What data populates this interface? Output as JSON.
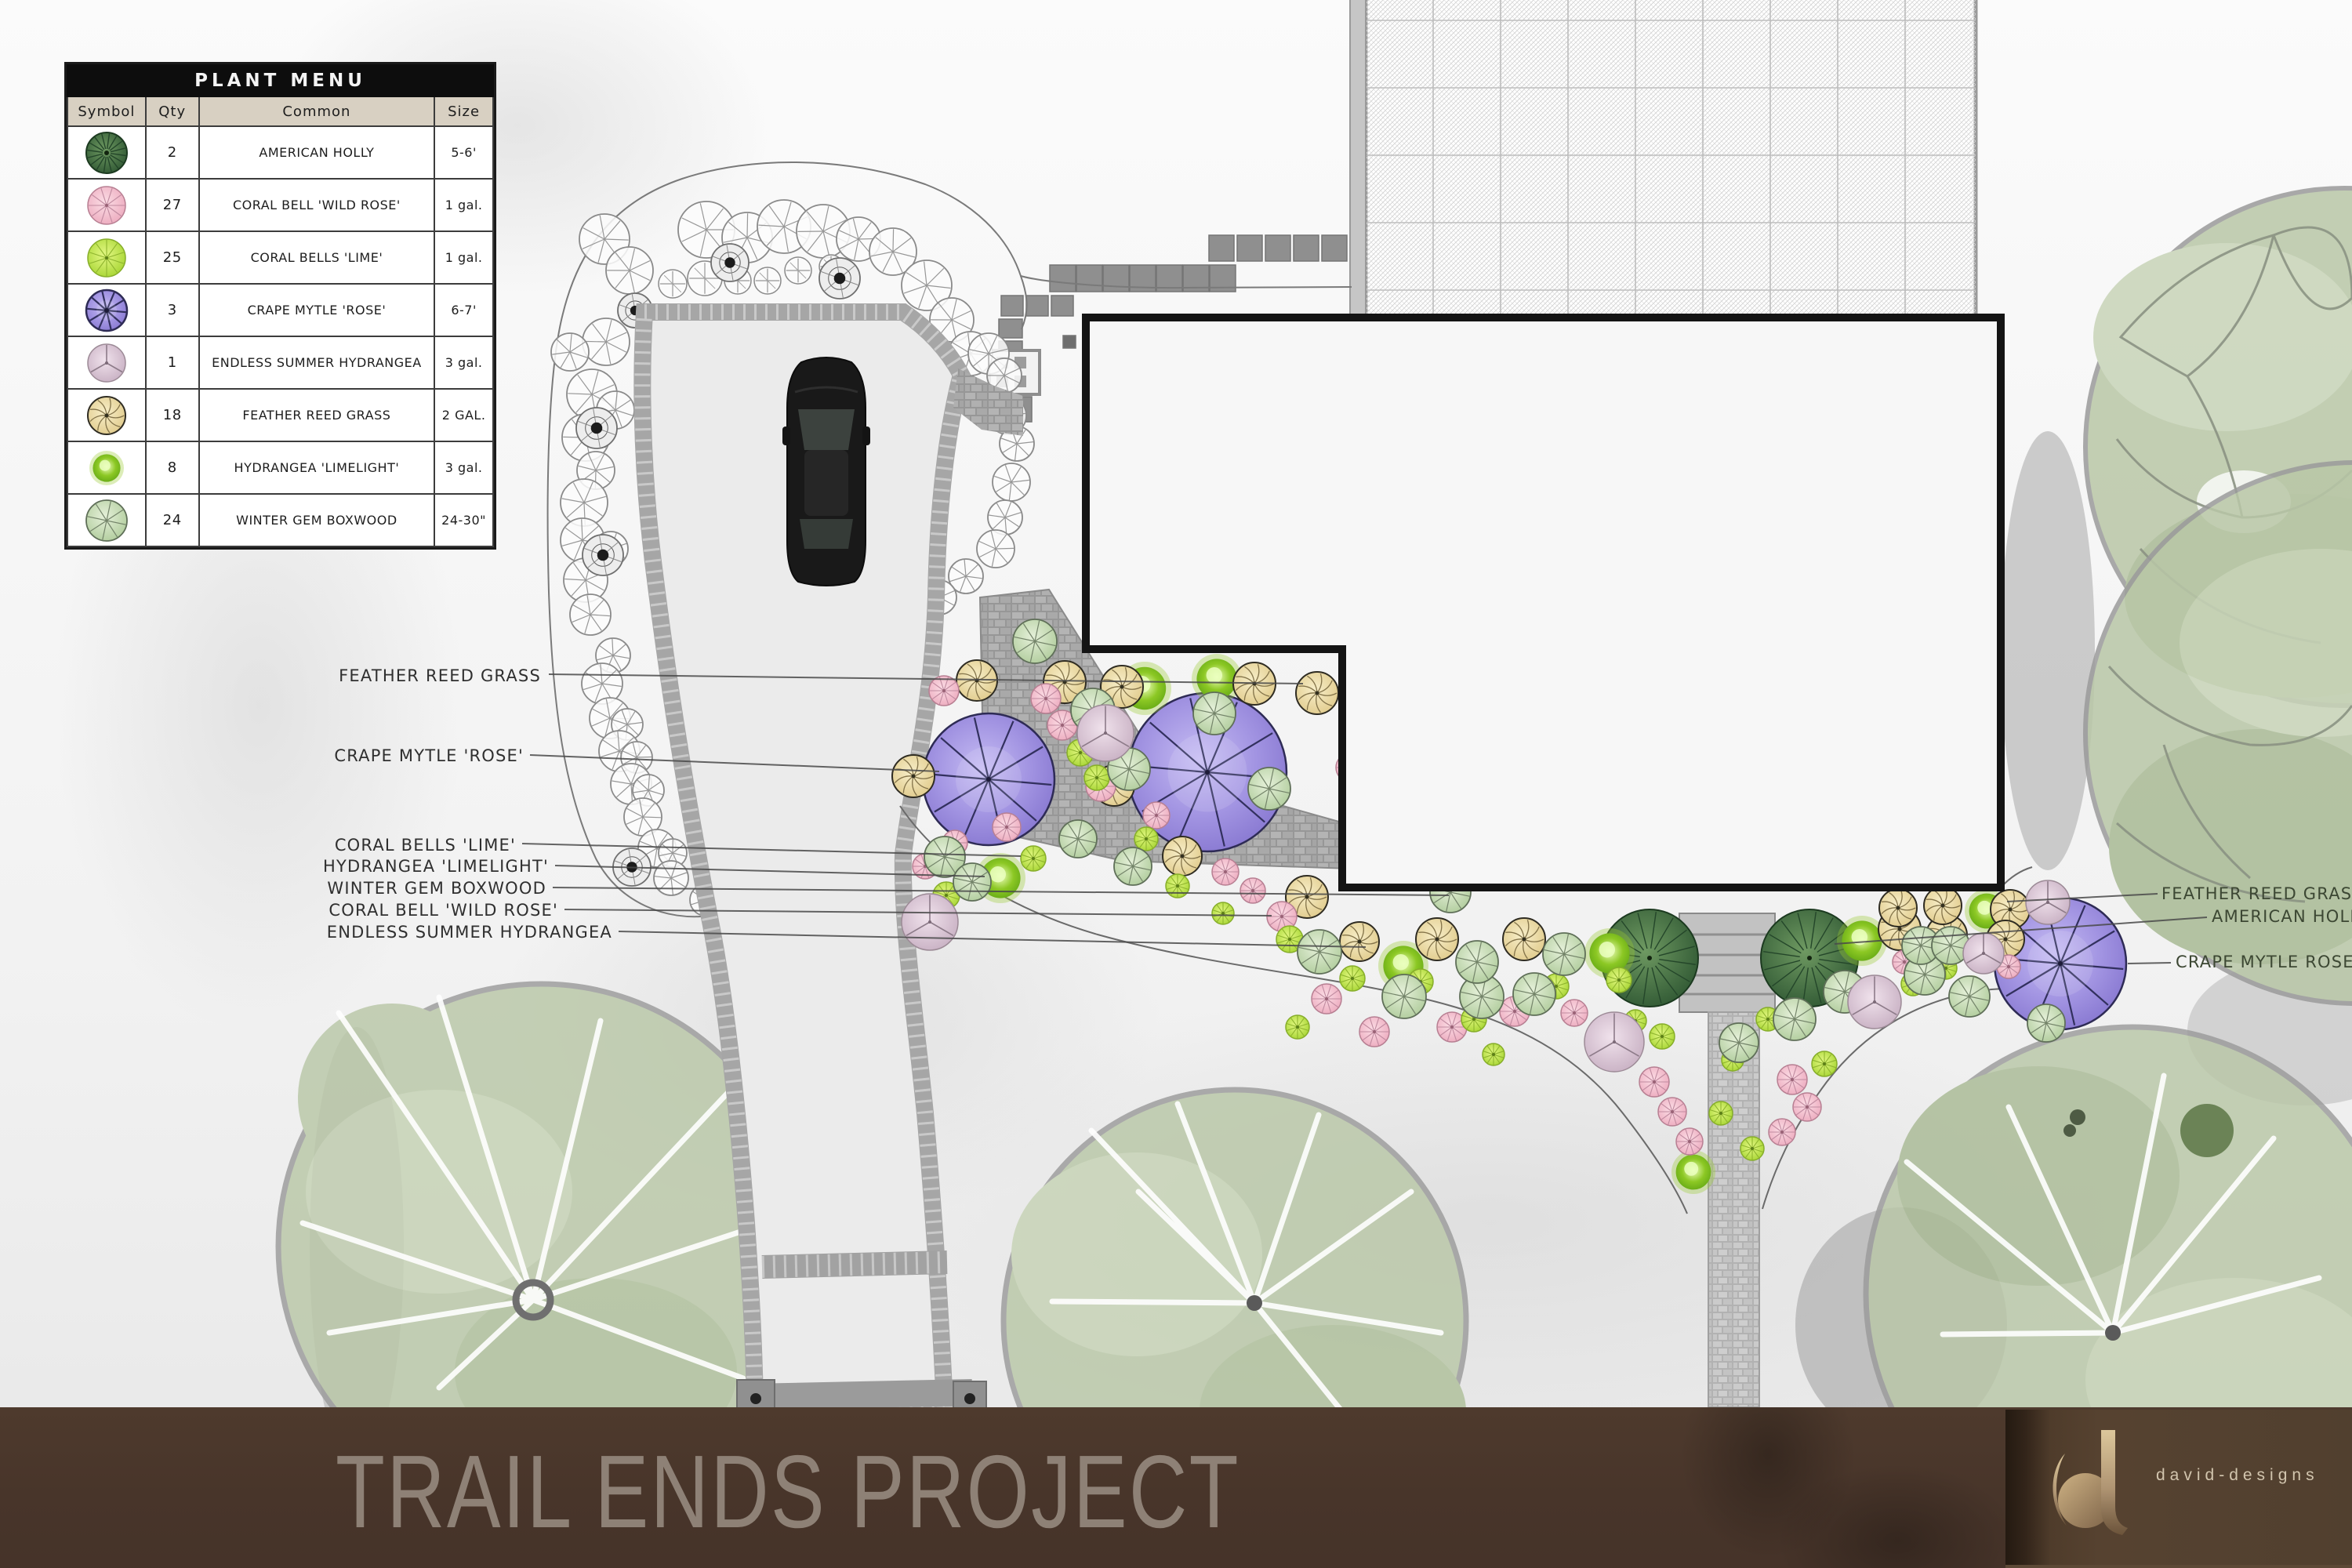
{
  "legend": {
    "title": "PLANT MENU",
    "columns": [
      "Symbol",
      "Qty",
      "Common",
      "Size"
    ],
    "rows": [
      {
        "symbol": "holly",
        "qty": "2",
        "common": "AMERICAN HOLLY",
        "size": "5-6'"
      },
      {
        "symbol": "wildrose",
        "qty": "27",
        "common": "CORAL BELL 'WILD ROSE'",
        "size": "1 gal."
      },
      {
        "symbol": "lime",
        "qty": "25",
        "common": "CORAL BELLS 'LIME'",
        "size": "1 gal."
      },
      {
        "symbol": "crape",
        "qty": "3",
        "common": "CRAPE MYTLE 'ROSE'",
        "size": "6-7'"
      },
      {
        "symbol": "summer",
        "qty": "1",
        "common": "ENDLESS SUMMER HYDRANGEA",
        "size": "3 gal."
      },
      {
        "symbol": "grass",
        "qty": "18",
        "common": "FEATHER REED GRASS",
        "size": "2 GAL."
      },
      {
        "symbol": "limelight",
        "qty": "8",
        "common": "HYDRANGEA 'LIMELIGHT'",
        "size": "3 gal."
      },
      {
        "symbol": "boxwood",
        "qty": "24",
        "common": "WINTER GEM BOXWOOD",
        "size": "24-30\""
      }
    ]
  },
  "labels": {
    "left": [
      "FEATHER REED GRASS",
      "CRAPE MYTLE 'ROSE'",
      "CORAL BELLS 'LIME'",
      "HYDRANGEA 'LIMELIGHT'",
      "WINTER GEM BOXWOOD",
      "CORAL BELL 'WILD ROSE'",
      "ENDLESS SUMMER HYDRANGEA"
    ],
    "right": [
      "FEATHER REED GRASS",
      "AMERICAN HOLLY",
      "CRAPE MYTLE ROSE'"
    ]
  },
  "footer": {
    "title": "TRAIL ENDS PROJECT",
    "brand": "david-designs",
    "monogram": "d"
  },
  "colors": {
    "bar_brown": "#47342a",
    "title_gray": "#8e8176",
    "crape_purple": "#9282d8",
    "holly_green": "#3d6a40",
    "lime_green": "#b8e045",
    "wildrose_pink": "#f2b9c9",
    "grass_yellow": "#ead9a0",
    "limelight_green": "#8cc824",
    "boxwood_sage": "#c4d9b2",
    "summer_mauve": "#d6c0d0",
    "tree_sage": "#b9c7a7",
    "gold_logo": "#d6c193"
  },
  "plan": {
    "plants": [
      [
        "crape",
        1261,
        994,
        84
      ],
      [
        "crape",
        1540,
        985,
        101
      ],
      [
        "crape",
        2628,
        1229,
        84
      ],
      [
        "holly",
        2104,
        1222,
        62
      ],
      [
        "holly",
        2308,
        1222,
        62
      ],
      [
        "limelight",
        1460,
        878,
        34
      ],
      [
        "limelight",
        1552,
        866,
        32
      ],
      [
        "limelight",
        1276,
        1120,
        32
      ],
      [
        "limelight",
        1790,
        1232,
        32
      ],
      [
        "limelight",
        2053,
        1216,
        32
      ],
      [
        "limelight",
        2375,
        1200,
        32
      ],
      [
        "limelight",
        2534,
        1162,
        28
      ],
      [
        "limelight",
        2160,
        1495,
        28
      ],
      [
        "grass",
        1246,
        868,
        26
      ],
      [
        "grass",
        1358,
        870,
        27
      ],
      [
        "grass",
        1431,
        876,
        27
      ],
      [
        "grass",
        1600,
        872,
        27
      ],
      [
        "grass",
        1680,
        884,
        27
      ],
      [
        "grass",
        1165,
        990,
        27
      ],
      [
        "grass",
        1421,
        1002,
        26
      ],
      [
        "grass",
        1508,
        1092,
        25
      ],
      [
        "grass",
        1667,
        1144,
        27
      ],
      [
        "grass",
        1734,
        1201,
        25
      ],
      [
        "grass",
        1833,
        1198,
        27
      ],
      [
        "grass",
        1944,
        1198,
        27
      ],
      [
        "grass",
        2423,
        1185,
        27
      ],
      [
        "grass",
        2483,
        1193,
        26
      ],
      [
        "grass",
        2421,
        1158,
        24
      ],
      [
        "grass",
        2478,
        1155,
        24
      ],
      [
        "grass",
        2564,
        1160,
        25
      ],
      [
        "grass",
        2558,
        1198,
        24
      ],
      [
        "wildrose",
        1204,
        881,
        19
      ],
      [
        "wildrose",
        1334,
        891,
        19
      ],
      [
        "wildrose",
        1355,
        925,
        19
      ],
      [
        "wildrose",
        1404,
        1003,
        19
      ],
      [
        "wildrose",
        1284,
        1055,
        18
      ],
      [
        "wildrose",
        1722,
        979,
        18
      ],
      [
        "wildrose",
        1475,
        1040,
        17
      ],
      [
        "wildrose",
        1563,
        1112,
        17
      ],
      [
        "wildrose",
        1598,
        1136,
        16
      ],
      [
        "wildrose",
        1635,
        1169,
        19
      ],
      [
        "wildrose",
        1692,
        1274,
        19
      ],
      [
        "wildrose",
        1753,
        1316,
        19
      ],
      [
        "wildrose",
        1852,
        1310,
        19
      ],
      [
        "wildrose",
        1932,
        1290,
        19
      ],
      [
        "wildrose",
        2008,
        1292,
        17
      ],
      [
        "wildrose",
        2110,
        1380,
        19
      ],
      [
        "wildrose",
        2133,
        1418,
        18
      ],
      [
        "wildrose",
        2155,
        1456,
        17
      ],
      [
        "wildrose",
        2286,
        1377,
        19
      ],
      [
        "wildrose",
        2305,
        1412,
        18
      ],
      [
        "wildrose",
        2273,
        1444,
        17
      ],
      [
        "wildrose",
        2384,
        1278,
        18
      ],
      [
        "wildrose",
        2429,
        1227,
        15
      ],
      [
        "wildrose",
        2562,
        1233,
        15
      ],
      [
        "wildrose",
        2461,
        1232,
        14
      ],
      [
        "wildrose",
        1218,
        1075,
        16
      ],
      [
        "wildrose",
        1180,
        1105,
        16
      ],
      [
        "lime",
        1378,
        960,
        17
      ],
      [
        "lime",
        1399,
        992,
        16
      ],
      [
        "lime",
        1207,
        1142,
        17
      ],
      [
        "lime",
        1318,
        1095,
        16
      ],
      [
        "lime",
        1462,
        1070,
        15
      ],
      [
        "lime",
        1502,
        1130,
        15
      ],
      [
        "lime",
        1645,
        1198,
        17
      ],
      [
        "lime",
        1725,
        1248,
        16
      ],
      [
        "lime",
        1812,
        1252,
        16
      ],
      [
        "lime",
        1880,
        1300,
        16
      ],
      [
        "lime",
        1985,
        1258,
        16
      ],
      [
        "lime",
        2065,
        1250,
        16
      ],
      [
        "lime",
        2120,
        1322,
        16
      ],
      [
        "lime",
        2195,
        1420,
        15
      ],
      [
        "lime",
        2235,
        1465,
        15
      ],
      [
        "lime",
        2255,
        1300,
        15
      ],
      [
        "lime",
        2327,
        1357,
        16
      ],
      [
        "lime",
        2440,
        1255,
        15
      ],
      [
        "lime",
        2515,
        1260,
        15
      ],
      [
        "lime",
        2482,
        1235,
        14
      ],
      [
        "lime",
        1655,
        1310,
        15
      ],
      [
        "lime",
        1905,
        1345,
        14
      ],
      [
        "lime",
        2086,
        1302,
        14
      ],
      [
        "lime",
        1560,
        1165,
        14
      ],
      [
        "lime",
        2210,
        1352,
        14
      ],
      [
        "boxwood",
        1320,
        818,
        28
      ],
      [
        "boxwood",
        1394,
        906,
        28
      ],
      [
        "boxwood",
        1549,
        910,
        27
      ],
      [
        "boxwood",
        1440,
        981,
        27
      ],
      [
        "boxwood",
        1619,
        1006,
        27
      ],
      [
        "boxwood",
        1205,
        1093,
        26
      ],
      [
        "boxwood",
        1240,
        1125,
        24
      ],
      [
        "boxwood",
        1683,
        1214,
        28
      ],
      [
        "boxwood",
        1791,
        1271,
        28
      ],
      [
        "boxwood",
        1890,
        1271,
        28
      ],
      [
        "boxwood",
        1884,
        1227,
        27
      ],
      [
        "boxwood",
        1957,
        1268,
        27
      ],
      [
        "boxwood",
        1995,
        1217,
        27
      ],
      [
        "boxwood",
        2289,
        1300,
        27
      ],
      [
        "boxwood",
        2353,
        1265,
        27
      ],
      [
        "boxwood",
        2455,
        1243,
        26
      ],
      [
        "boxwood",
        2512,
        1271,
        26
      ],
      [
        "boxwood",
        1850,
        1138,
        26
      ],
      [
        "boxwood",
        2450,
        1206,
        24
      ],
      [
        "boxwood",
        2488,
        1206,
        24
      ],
      [
        "boxwood",
        1375,
        1070,
        24
      ],
      [
        "boxwood",
        2218,
        1330,
        25
      ],
      [
        "boxwood",
        2610,
        1305,
        24
      ],
      [
        "boxwood",
        1445,
        1105,
        24
      ],
      [
        "summer",
        1410,
        935,
        36
      ],
      [
        "summer",
        1186,
        1176,
        36
      ],
      [
        "summer",
        2059,
        1329,
        38
      ],
      [
        "summer",
        2391,
        1278,
        34
      ],
      [
        "summer",
        2612,
        1151,
        28
      ],
      [
        "summer",
        2530,
        1216,
        26
      ]
    ],
    "shrubs": [
      [
        "shrub",
        771,
        305,
        32
      ],
      [
        "shrub",
        803,
        345,
        30
      ],
      [
        "shrub",
        901,
        293,
        36
      ],
      [
        "shrub",
        953,
        303,
        32
      ],
      [
        "shrub",
        1000,
        289,
        34
      ],
      [
        "shrub",
        1050,
        295,
        34
      ],
      [
        "shrub",
        1095,
        305,
        28
      ],
      [
        "shrub",
        1139,
        321,
        30
      ],
      [
        "shrub",
        1182,
        364,
        32
      ],
      [
        "shrub",
        1214,
        408,
        28
      ],
      [
        "shrub",
        1238,
        451,
        28
      ],
      [
        "shrub",
        773,
        436,
        30
      ],
      [
        "shrub",
        727,
        449,
        24
      ],
      [
        "shrub",
        755,
        503,
        32
      ],
      [
        "shrub",
        785,
        523,
        24
      ],
      [
        "shrub",
        747,
        558,
        30
      ],
      [
        "shrub",
        760,
        600,
        24
      ],
      [
        "shrub",
        745,
        641,
        30
      ],
      [
        "shrub",
        743,
        689,
        28
      ],
      [
        "shrub",
        779,
        700,
        22
      ],
      [
        "shrub",
        747,
        740,
        28
      ],
      [
        "shrub",
        753,
        784,
        26
      ],
      [
        "shrub",
        782,
        836,
        22
      ],
      [
        "shrub",
        768,
        872,
        26
      ],
      [
        "shrub",
        778,
        916,
        26
      ],
      [
        "shrub",
        800,
        924,
        20
      ],
      [
        "shrub",
        790,
        958,
        26
      ],
      [
        "shrub",
        812,
        966,
        20
      ],
      [
        "shrub",
        805,
        1000,
        26
      ],
      [
        "shrub",
        827,
        1008,
        20
      ],
      [
        "shrub",
        820,
        1042,
        24
      ],
      [
        "shrub",
        838,
        1082,
        24
      ],
      [
        "shrub",
        858,
        1088,
        18
      ],
      [
        "shrub",
        856,
        1120,
        22
      ],
      [
        "shrub",
        900,
        1148,
        20
      ],
      [
        "shrub",
        1261,
        451,
        26
      ],
      [
        "shrub",
        1281,
        479,
        22
      ],
      [
        "shrub",
        1285,
        530,
        24
      ],
      [
        "shrub",
        1297,
        566,
        22
      ],
      [
        "shrub",
        1290,
        615,
        24
      ],
      [
        "shrub",
        1282,
        660,
        22
      ],
      [
        "shrub",
        1270,
        700,
        24
      ],
      [
        "shrub",
        1232,
        735,
        22
      ],
      [
        "shrub",
        1198,
        762,
        22
      ],
      [
        "crossed",
        899,
        355,
        22
      ],
      [
        "crossed",
        941,
        358,
        17
      ],
      [
        "crossed",
        979,
        358,
        17
      ],
      [
        "crossed",
        1018,
        345,
        17
      ],
      [
        "crossed",
        858,
        362,
        18
      ],
      [
        "crossed",
        1060,
        340,
        15
      ],
      [
        "darkswirl",
        931,
        335,
        24
      ],
      [
        "darkswirl",
        1071,
        355,
        26
      ],
      [
        "darkswirl",
        810,
        396,
        22
      ],
      [
        "darkswirl",
        761,
        546,
        26
      ],
      [
        "darkswirl",
        769,
        708,
        26
      ],
      [
        "darkswirl",
        806,
        1106,
        24
      ]
    ]
  }
}
